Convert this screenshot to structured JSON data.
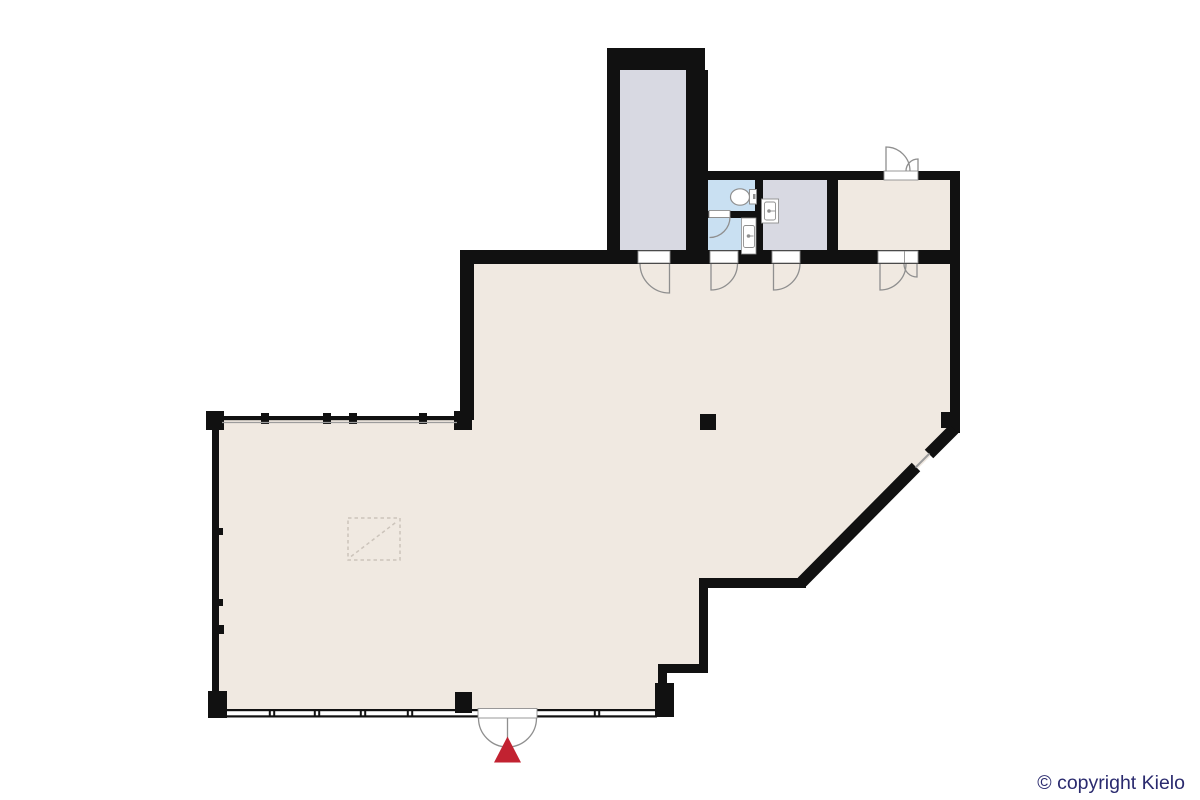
{
  "copyright": {
    "text": "© copyright Kielo",
    "color": "#2a2a6e"
  },
  "colors": {
    "background": "#ffffff",
    "wall": "#111111",
    "room_main": "#f0e9e1",
    "room_stairwell": "#d8d9e2",
    "room_wet": "#c9e0f2",
    "room_aux": "#d8d9e2",
    "room_top_right": "#f0e9e1",
    "door_line": "#8f8f8f",
    "window_line": "#9c9c9c",
    "fixture_line": "#8f8f8f",
    "fixture_fill": "#ffffff",
    "entrance_marker": "#c22231",
    "floor_opening_line": "#ccc4bb"
  },
  "icons": {
    "entrance_marker": "red-triangle-up-arrow",
    "toilet": "toilet-top-view",
    "sink": "sink-top-view",
    "counter_sink": "counter-sink-top-view",
    "door": "quarter-arc-door-swing",
    "double_door": "double-arc-door-swing",
    "window": "double-line-window-band",
    "floor_opening": "dashed-square-diagonal-hatch",
    "column": "black-square-column"
  },
  "rooms": [
    {
      "id": "main-hall",
      "color_key": "room_main"
    },
    {
      "id": "stairwell",
      "color_key": "room_stairwell"
    },
    {
      "id": "wc",
      "color_key": "room_wet"
    },
    {
      "id": "washroom",
      "color_key": "room_wet"
    },
    {
      "id": "utility-room",
      "color_key": "room_aux"
    },
    {
      "id": "side-room",
      "color_key": "room_top_right"
    }
  ]
}
